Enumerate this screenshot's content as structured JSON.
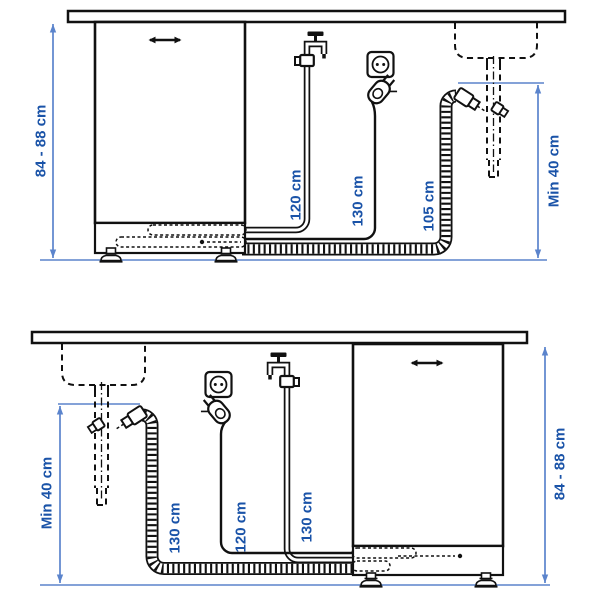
{
  "colors": {
    "label_blue": "#1a53a8",
    "dimension_blue": "#5b84cc",
    "line_black": "#111111",
    "background": "#ffffff"
  },
  "icons": {
    "tap": "water-tap-icon",
    "outlet": "power-outlet-icon",
    "plug": "power-plug-icon",
    "sink": "sink-basin-dashed",
    "foot": "adjustable-foot-icon",
    "handle": "door-handle-icon",
    "arrow": "dimension-arrowhead"
  },
  "panels": [
    {
      "labels": {
        "cabinet_height": "84 - 88 cm",
        "supply_hose": "120 cm",
        "power_cord": "130 cm",
        "drain_hose": "105 cm",
        "drain_min_height": "Min 40 cm"
      }
    },
    {
      "labels": {
        "drain_min_height": "Min 40 cm",
        "drain_hose": "130 cm",
        "power_cord": "120 cm",
        "supply_hose": "130 cm",
        "cabinet_height": "84 - 88 cm"
      }
    }
  ]
}
